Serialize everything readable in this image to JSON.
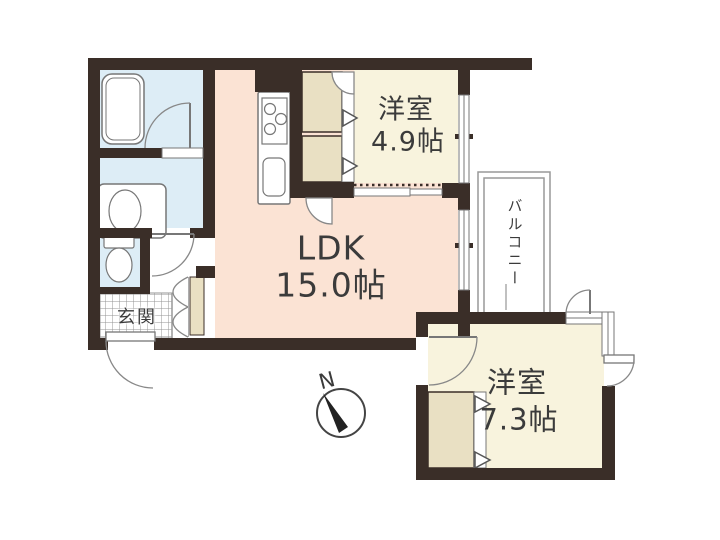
{
  "floor_plan": {
    "rooms": {
      "ldk": {
        "label": "LDK",
        "size": "15.0帖"
      },
      "bedroom_top": {
        "label": "洋室",
        "size": "4.9帖"
      },
      "bedroom_bottom": {
        "label": "洋室",
        "size": "7.3帖"
      },
      "balcony": {
        "label": "バルコニー"
      },
      "entrance": {
        "label": "玄関"
      }
    },
    "compass": {
      "north_label": "N"
    },
    "fixture_icons": [
      "bathtub-icon",
      "washbasin-icon",
      "toilet-icon",
      "kitchen-counter-icon",
      "stove-burners-icon",
      "kitchen-sink-icon",
      "compass-icon",
      "door-arc-icon",
      "closet-fold-arrow-icon"
    ],
    "colors": {
      "background": "#ffffff",
      "wall": "#3a2e28",
      "ldk_floor": "#fbe3d4",
      "bedroom_floor": "#f8f3dd",
      "wet_area_floor": "#ddedf6",
      "closet_fill": "#e9e0c3",
      "fixture_outline": "#888888",
      "balcony_outline": "#999999",
      "text": "#3b3b3b"
    }
  }
}
